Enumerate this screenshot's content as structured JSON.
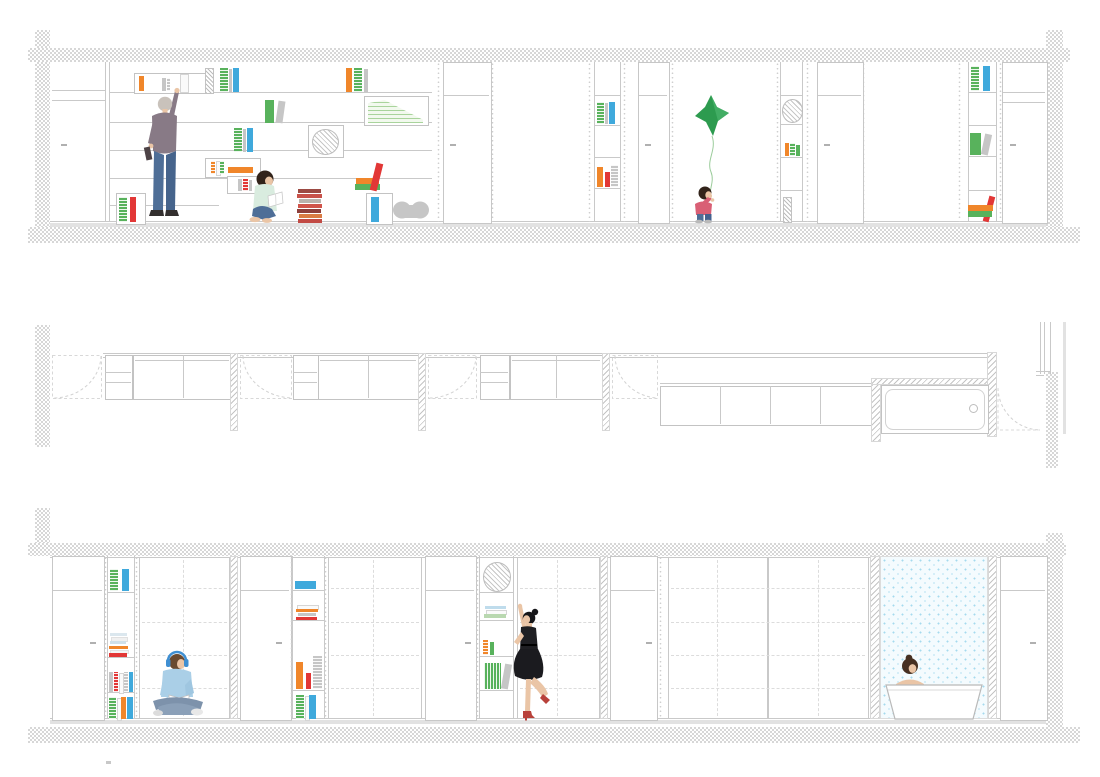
{
  "document": {
    "type": "architectural-section-drawing",
    "title": "Apartment long sections and plan strip with bookshelves, sliding wardrobes and bathroom"
  },
  "colors": {
    "wall-line": "#c9c9c9",
    "hatch-line": "#c4c4c4",
    "checker-gray": "#d7d7d7",
    "book-green": "#58b25c",
    "book-green-light": "#a9d49c",
    "book-blue": "#3fa9dc",
    "book-orange": "#f0862a",
    "book-red": "#e23736",
    "book-maroon": "#9c4a43",
    "book-gray": "#c6c6c6",
    "balloon-green": "#2d9b4f",
    "balloon-green-light": "#47b169",
    "string-green": "#9bcc9b",
    "tile-bg": "#f4fbfe",
    "tile-dot": "#a5daee",
    "skin": "#eac5a6",
    "hair-gray": "#c9c2bb",
    "hair-brown": "#6a4a30",
    "hair-dark": "#32231a",
    "hair-black": "#17171a",
    "shirt-mauve": "#887a86",
    "shirt-mint": "#d9ecdf",
    "shirt-pink": "#d95f75",
    "shirt-blue": "#aacfe7",
    "jeans": "#4e6e97",
    "pants-gray": "#7d92ab",
    "dress-black": "#1f1f23",
    "heel-red": "#b8413a",
    "shoe-dark": "#332f2e"
  },
  "sections": [
    {
      "id": "upper-elevation",
      "label": "Upper long section: bookshelf wall with figures"
    },
    {
      "id": "plan-strip",
      "label": "Plan strip: doors, cabinets, windows and bathtub"
    },
    {
      "id": "lower-elevation",
      "label": "Lower long section: wardrobes, shelf columns and bathroom"
    }
  ],
  "figures": [
    {
      "id": "elderly-man-reaching",
      "section": "upper-elevation"
    },
    {
      "id": "boy-reading-against-book-stack",
      "section": "upper-elevation"
    },
    {
      "id": "toddler-with-green-star-balloon",
      "section": "upper-elevation"
    },
    {
      "id": "man-with-headphones-reading",
      "section": "lower-elevation"
    },
    {
      "id": "woman-black-dress-reaching-clock",
      "section": "lower-elevation"
    },
    {
      "id": "woman-in-bathtub",
      "section": "lower-elevation"
    }
  ],
  "fixtures": [
    {
      "id": "bathtub-plan",
      "section": "plan-strip"
    },
    {
      "id": "bathtub-elevation",
      "section": "lower-elevation"
    },
    {
      "id": "pet-bed",
      "section": "upper-elevation"
    },
    {
      "id": "wall-clock-hatched",
      "section": "lower-elevation"
    }
  ]
}
